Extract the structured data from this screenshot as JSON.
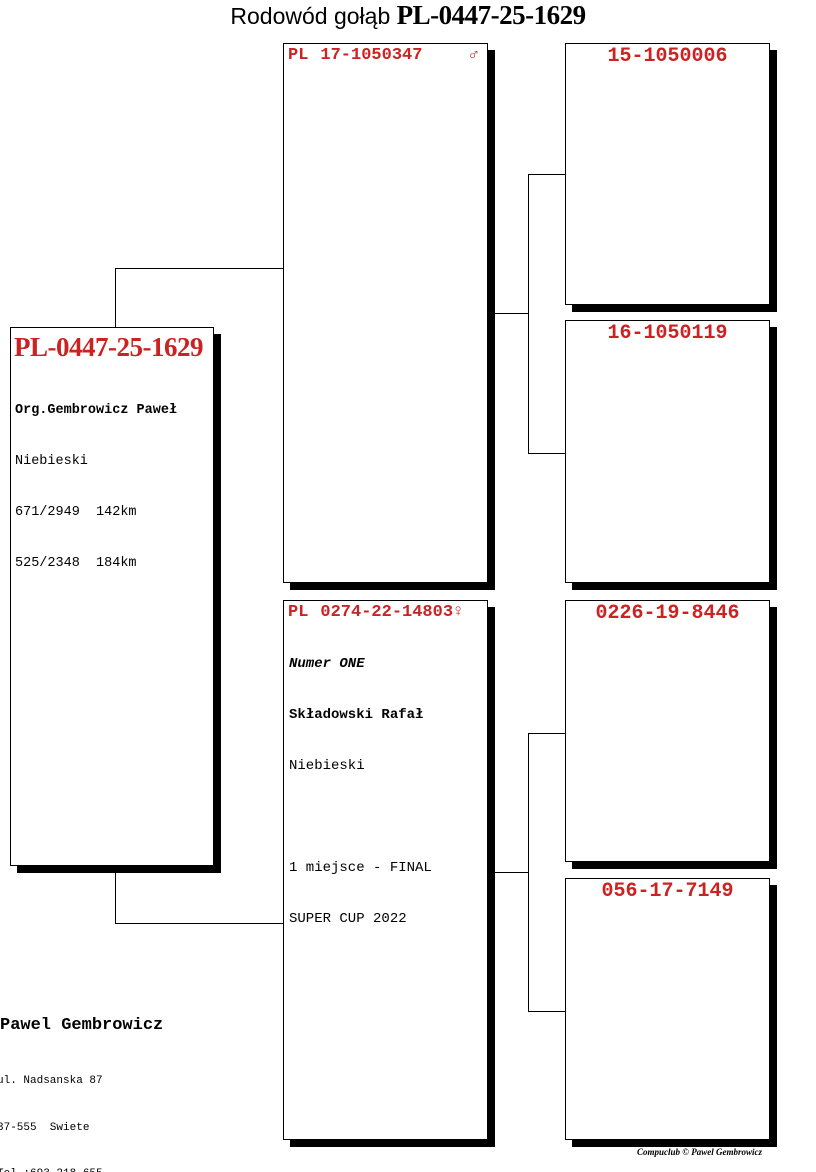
{
  "title": {
    "prefix": "Rodowód gołąb ",
    "ring": "PL-0447-25-1629"
  },
  "subject": {
    "ring": "PL-0447-25-1629",
    "org": "Org.Gembrowicz Paweł",
    "color": "Niebieski",
    "results": [
      "671/2949  142km",
      "525/2348  184km"
    ]
  },
  "father": {
    "country": "PL",
    "ring": "17-1050347",
    "sex": "♂"
  },
  "mother": {
    "country": "PL",
    "ring": "0274-22-14803",
    "sex": "♀",
    "name": "Numer ONE",
    "owner": "Składowski Rafał",
    "color": "Niebieski",
    "achievements": [
      "1 miejsce - FINAL",
      "SUPER CUP 2022"
    ]
  },
  "grandparents": [
    {
      "ring": "15-1050006"
    },
    {
      "ring": "16-1050119"
    },
    {
      "ring": "0226-19-8446"
    },
    {
      "ring": "056-17-7149"
    }
  ],
  "footer": {
    "name": "Pawel Gembrowicz",
    "address": [
      "ul. Nadsanska 87",
      "37-555  Swiete",
      "Tel.:693-218-655"
    ]
  },
  "watermark": "Compuclub © Pawel Gembrowicz",
  "colors": {
    "accent_red": "#cc2222",
    "line_black": "#000000",
    "background": "#ffffff"
  }
}
